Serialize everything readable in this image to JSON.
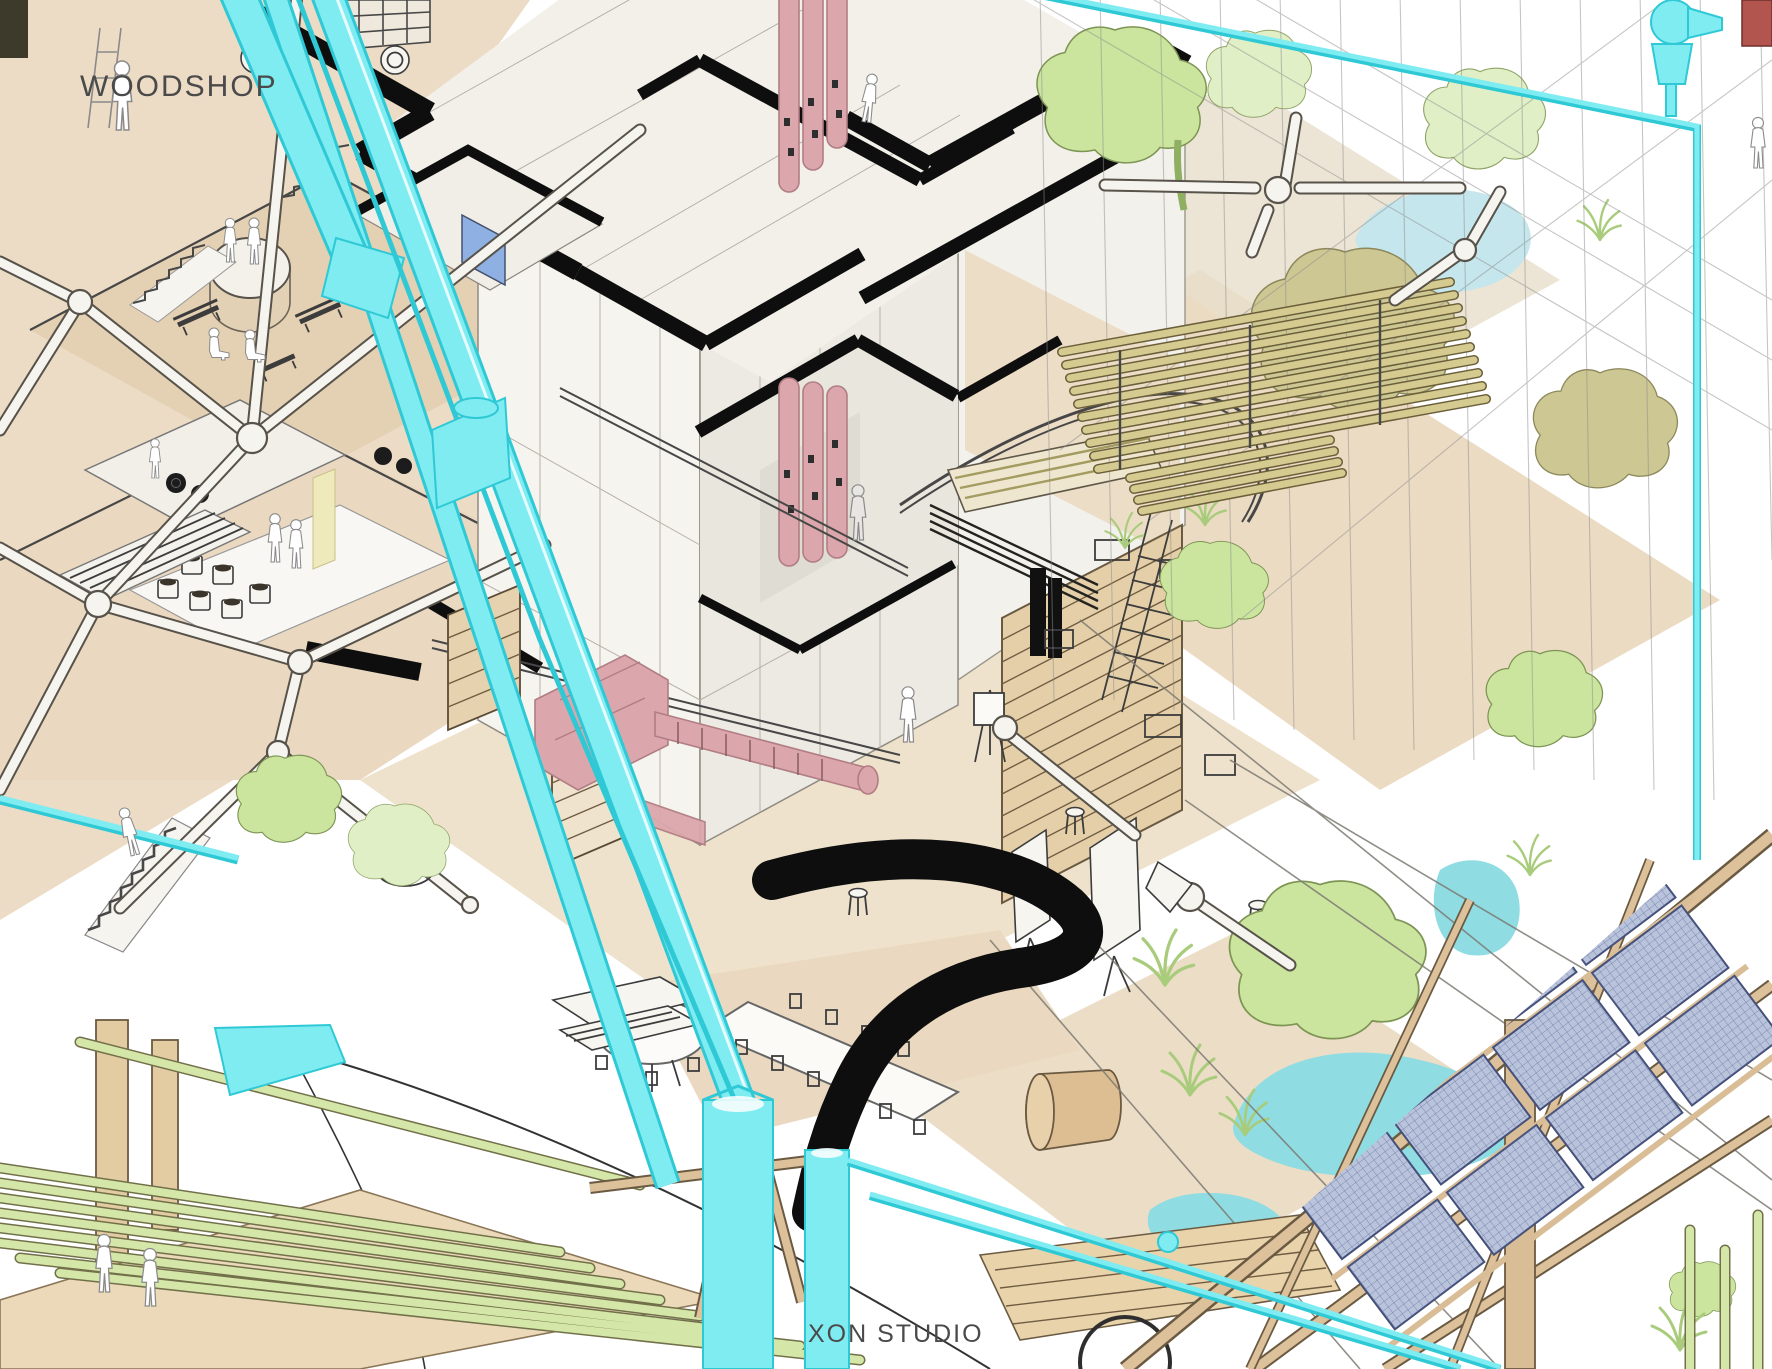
{
  "page": {
    "title": "XON Studio axonometric cutaway illustration"
  },
  "labels": {
    "woodshop": "WOODSHOP",
    "studio": "XON STUDIO"
  },
  "colors": {
    "bg": "#ffffff",
    "ivory": "#f4f1eb",
    "paperFace": "#efece4",
    "tan": "#ead9c0",
    "tanDark": "#ddc8a8",
    "wood": "#d9ba8e",
    "line": "#474747",
    "black": "#0e0e0e",
    "cyan": "#7fecf2",
    "cyanDeep": "#2fc9d6",
    "pink": "#dca7ac",
    "pinkDeep": "#b07e84",
    "treeLight": "#cbe59e",
    "treePale": "#e0efc6",
    "treeOlive": "#cdc793",
    "grassGreen": "#a9cc7c",
    "water": "#8fdce2",
    "waterPale": "#c5e6ec",
    "glassBlue": "#8fb0e2",
    "solar": "#b9c3dc",
    "solarLine": "#5f6d99",
    "bamboo": "#d5e7a8",
    "labelGray": "#4a4a4a"
  },
  "scene": {
    "elements": [
      "woodshop-mezzanines",
      "space-frame-structure",
      "central-tower-plan-cut",
      "pink-climbing-ducts",
      "cutaway-opening",
      "workshop-floor",
      "garden-atrium",
      "ponds",
      "bamboo-rack",
      "timber-solar-truss",
      "solar-panel-array",
      "cyan-brace-beams",
      "cyan-duct-columns",
      "cyan-pipes",
      "black-section-curve",
      "dining-area",
      "kitchen-counters",
      "bamboo-pole-bridge",
      "stairs",
      "figures"
    ],
    "figure_count": 15
  }
}
